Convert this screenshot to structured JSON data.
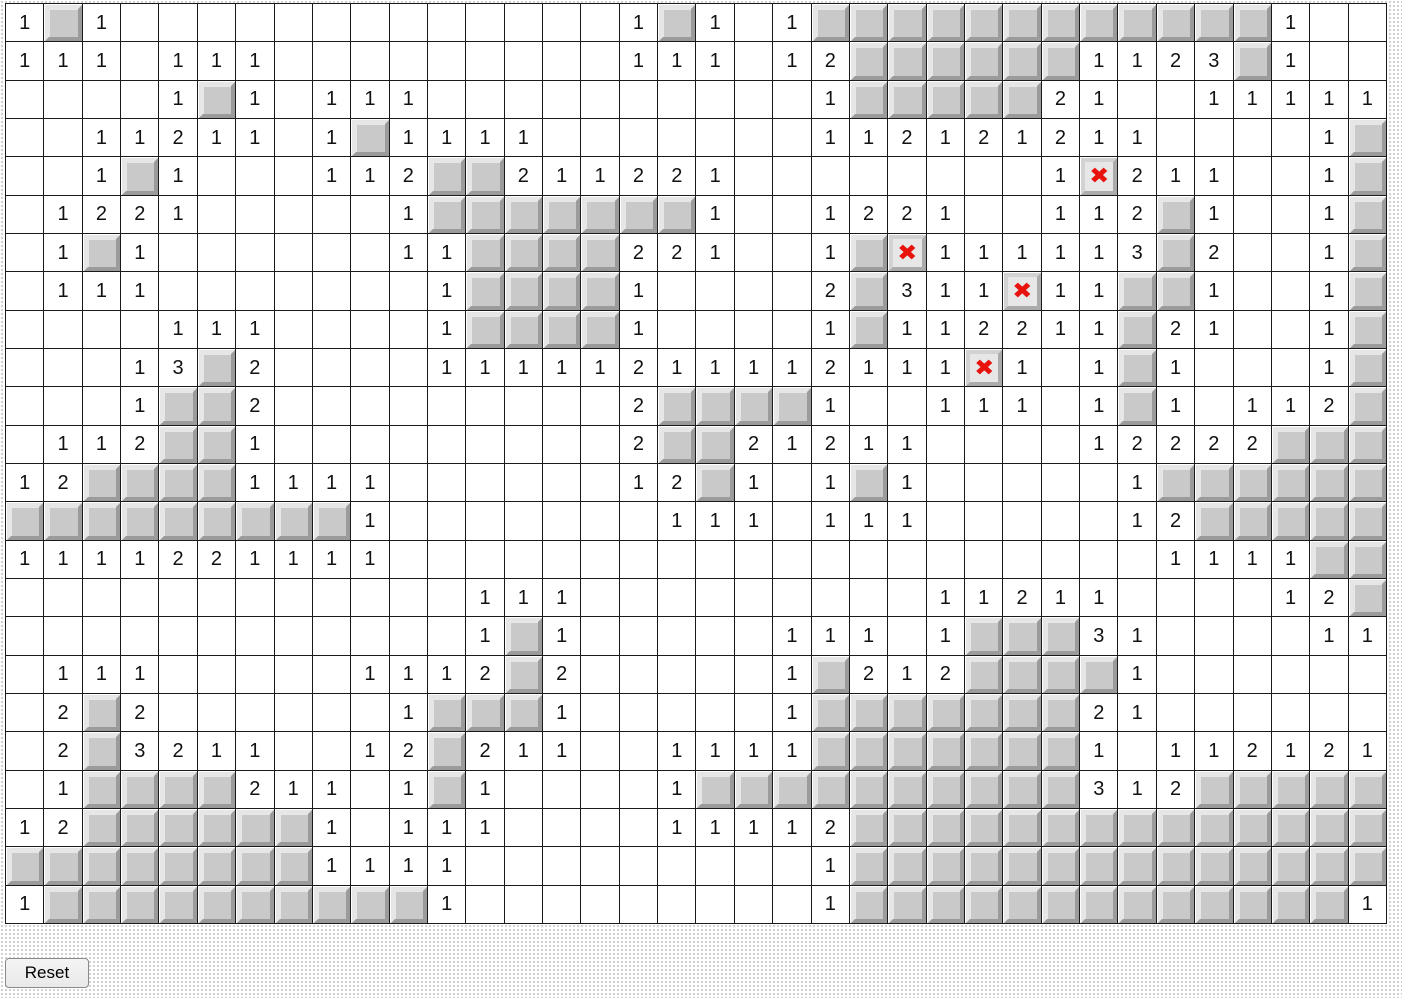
{
  "board": {
    "columns": 36,
    "row_count": 24,
    "legend": {
      ".": "revealed-empty-cell",
      "#": "unrevealed-raised-tile",
      "X": "red-x-marked-cell",
      "digits": "revealed-number-cell"
    },
    "rows": [
      "1#1.............1#1.1############1..",
      "111.111.........111.12######1123#1..",
      "....1#1.111..........1#####21..11111",
      "..11211.1#1111.......112121211....1#",
      "..1#1...112##211221........1X211..1#",
      ".1221.....1#######1..1221..112#1..1#",
      ".1#1......11####221..1#X111113#2..1#",
      ".111.......1####1....2#311X11##1..1#",
      "....111....1####1....1#112211#21..1#",
      "...13#2....11111211112111X1.1#1...1#",
      "...1##2.........2####1..111.1#1.112#",
      ".112##1.........2##21211....12222###",
      "12####1111......12#1.1#1.....1######",
      "#########1.......111.111.....12#####",
      "1111221111....................1111##",
      "............111.........11211....12#",
      "............1#1.....111.1###31....11",
      ".111.....1112#2.....1#212####1......",
      ".2#2......1###1.....1#######21......",
      ".2#3211..12#211..1111#######1.112121",
      ".1####211.1#1....1##########312#####",
      "12######1.111....11112##############",
      "########1111.........1##############",
      "1##########1.........1#############1"
    ],
    "x_glyph": "✖",
    "colors": {
      "grid_line": "#1a1a1a",
      "cell_bg": "#ffffff",
      "number": "#111111",
      "tile_face": "#c9c9c9",
      "tile_light": "#e6e6e6",
      "tile_shadow": "#9b9b9b",
      "x_face": "#e7e7e7",
      "x_bevel_light": "#d2d2d2",
      "x_bevel_dark": "#ababab",
      "x_mark": "#e8130c",
      "page_dot": "#d0d0d0"
    }
  },
  "controls": {
    "reset_label": "Reset"
  }
}
